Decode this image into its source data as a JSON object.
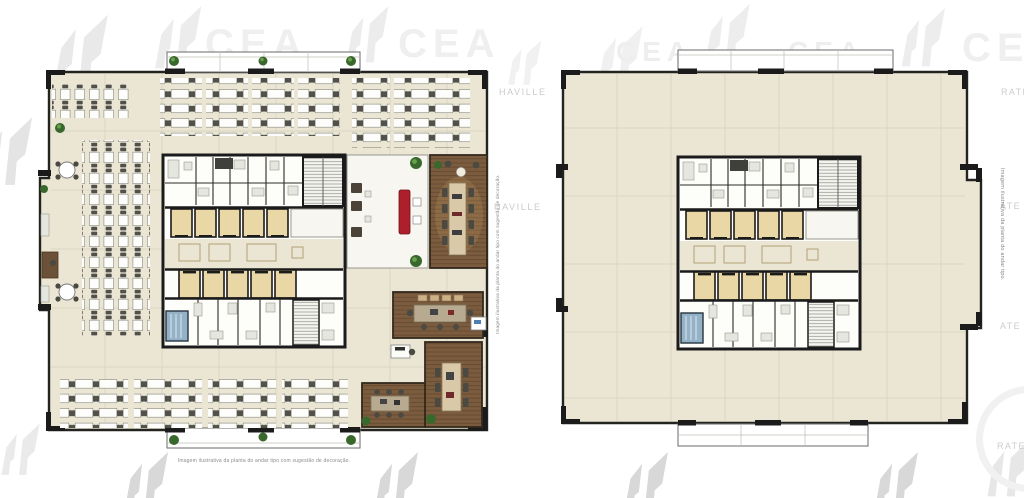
{
  "captions": {
    "left_bottom": "Imagem ilustrativa da planta do andar tipo com sugestão de decoração.",
    "left_side": "Imagem ilustrativa da planta do andar tipo com sugestão de decoração.",
    "right_side": "Imagem ilustrativa da planta do andar tipo."
  },
  "watermark": {
    "brand": "CEA",
    "name": "HAVILLE",
    "fragment_ate": "ATE",
    "fragment_rate": "RATE"
  },
  "colors": {
    "floor": "#eae6d3",
    "room_beige": "#e9d8a6",
    "wall": "#1b1b1b",
    "wood": "#7c5c3e",
    "table_tan": "#d9c9a9",
    "sofa_red": "#ad1f2b",
    "plant_green": "#39682c",
    "water_blue": "#93b1c7",
    "watermark_gray": "#e9e9e9",
    "caption_gray": "#8a8a8a"
  }
}
